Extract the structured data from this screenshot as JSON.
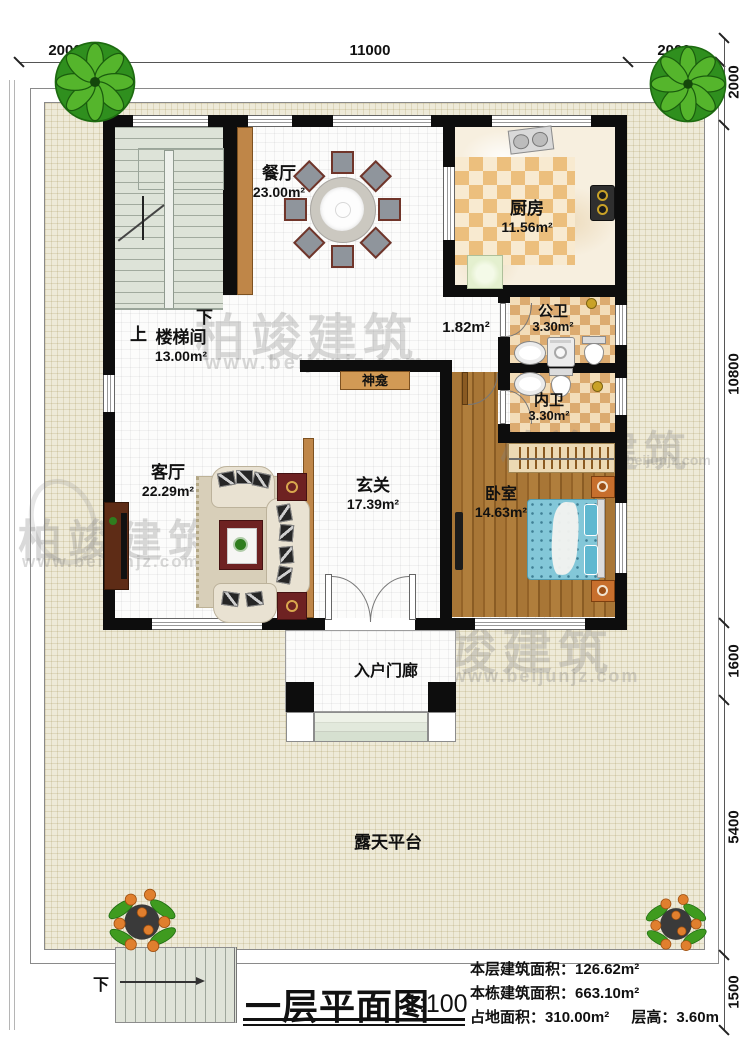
{
  "drawing": {
    "title": "一层平面图",
    "scale": "1:100",
    "stats": [
      {
        "label": "本层建筑面积：",
        "value": "126.62m²"
      },
      {
        "label": "本栋建筑面积：",
        "value": "663.10m²"
      },
      {
        "label": "占地面积：",
        "value": "310.00m²"
      },
      {
        "label": "层高：",
        "value": "3.60m"
      }
    ]
  },
  "dimensions": {
    "top": [
      "2000",
      "11000",
      "2000"
    ],
    "right": [
      "2000",
      "10800",
      "1600",
      "5400",
      "1500"
    ]
  },
  "rooms": [
    {
      "name": "餐厅",
      "area": "23.00m²"
    },
    {
      "name": "厨房",
      "area": "11.56m²"
    },
    {
      "name": "楼梯间",
      "area": "13.00m²"
    },
    {
      "name": "公卫",
      "area": "3.30m²"
    },
    {
      "name": "内卫",
      "area": "3.30m²"
    },
    {
      "name": "客厅",
      "area": "22.29m²"
    },
    {
      "name": "玄关",
      "area": "17.39m²"
    },
    {
      "name": "卧室",
      "area": "14.63m²"
    },
    {
      "name": "",
      "area": "1.82m²"
    }
  ],
  "labels": {
    "shrine": "神龛",
    "entry_porch": "入户门廊",
    "terrace": "露天平台",
    "stair_up": "上",
    "stair_down": "下",
    "outdoor_stair_down": "下"
  },
  "watermark": {
    "brand": "柏竣建筑",
    "url": "www.beijunjz.com"
  },
  "colors": {
    "wall": "#0d0d0d",
    "wood_trim": "#bf8648",
    "bed": "#7cc4d6",
    "checker": "#dcab70",
    "nightstand": "#c76f2d",
    "plant_green": "#3f9b1f"
  }
}
